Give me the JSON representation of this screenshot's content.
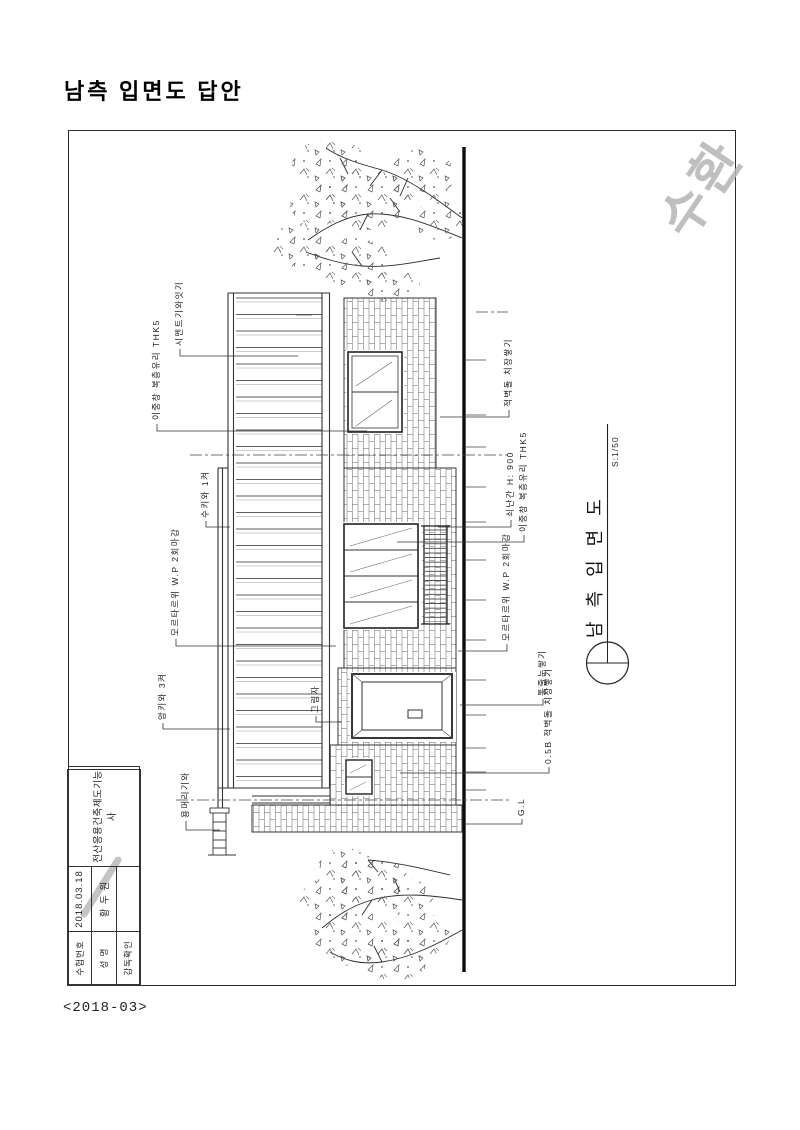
{
  "page": {
    "title": "남측 입면도 답안",
    "footer": "<2018-03>",
    "watermark": "수환"
  },
  "titleblock": {
    "exam_no_label": "수험번호",
    "exam_date": "2018.03.18",
    "name_label": "성  명",
    "name_value": "황 두 원",
    "supervisor_label": "감독확인",
    "supervisor_value": "",
    "cert_title": "전산응용건축제도기능사"
  },
  "drawing": {
    "title": "남측입면도",
    "scale": "S:1/50",
    "annotations": {
      "cement_tile": "시멘트기와잇기",
      "double_window_left": "이중창 복층유리 THK5",
      "convex_tile": "수키와 1켜",
      "mortar_left": "모르타르위 W.P 2회마감",
      "concave_tile": "암키와 3켜",
      "ridge_end_tile": "용머리기와",
      "shadow": "그림자",
      "brick_laying": "적벽돌 치장쌓기",
      "handrail": "쇠난간 H: 900",
      "double_window_right": "이중창 복층유리 THK5",
      "mortar_right": "모르타르위 W.P 2회마감",
      "joint": "통줄눈쌓기",
      "brick_05b": "0.5B 적벽돌 치장쌓기",
      "ground_line": "G.L"
    }
  }
}
